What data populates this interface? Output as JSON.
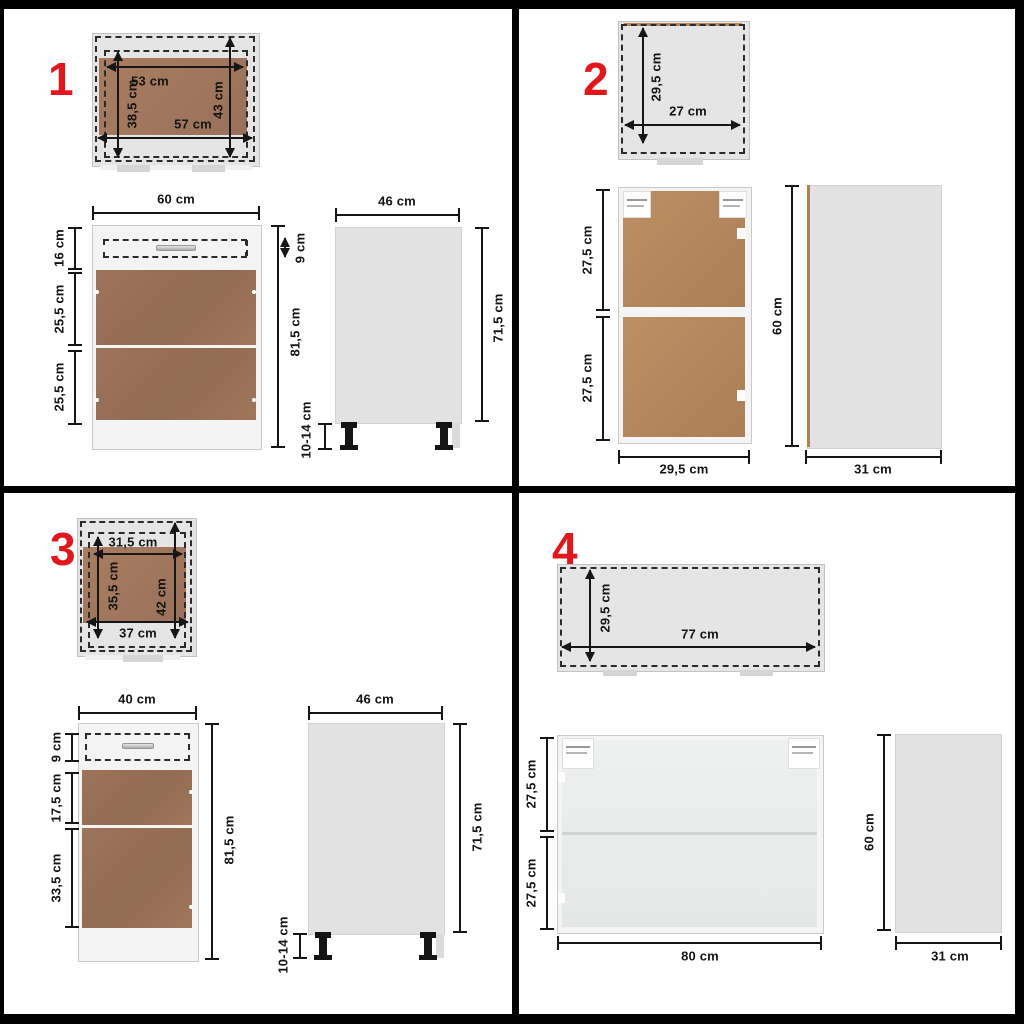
{
  "colors": {
    "accent_red": "#e0181d",
    "frame_black": "#000000",
    "wood_dark": "#9a7159",
    "wood_tan": "#b5875f",
    "panel_gray": "#e3e3e3",
    "glass_gray": "#eaeceb"
  },
  "panels": [
    {
      "number": "1",
      "top": {
        "w_inner": "53 cm",
        "w_outer": "57 cm",
        "d_inner": "38,5 cm",
        "d_outer": "43 cm"
      },
      "front": {
        "width": "60 cm",
        "drawer": "16 cm",
        "drawer_front": "9 cm",
        "door_top": "25,5 cm",
        "door_bottom": "25,5 cm",
        "height": "81,5 cm"
      },
      "side": {
        "depth": "46 cm",
        "height": "71,5 cm",
        "legs": "10-14 cm"
      }
    },
    {
      "number": "2",
      "top": {
        "depth": "29,5 cm",
        "width": "27 cm"
      },
      "front": {
        "sec_top": "27,5 cm",
        "sec_bottom": "27,5 cm",
        "width": "29,5 cm"
      },
      "side": {
        "height": "60 cm",
        "depth": "31 cm"
      }
    },
    {
      "number": "3",
      "top": {
        "w_inner": "31,5 cm",
        "w_outer": "37 cm",
        "d_inner": "35,5 cm",
        "d_outer": "42 cm"
      },
      "front": {
        "width": "40 cm",
        "drawer": "9 cm",
        "door_top": "17,5 cm",
        "door_bottom": "33,5 cm",
        "height": "81,5 cm"
      },
      "side": {
        "depth": "46 cm",
        "height": "71,5 cm",
        "legs": "10-14 cm"
      }
    },
    {
      "number": "4",
      "top": {
        "depth": "29,5 cm",
        "width": "77 cm"
      },
      "front": {
        "sec_top": "27,5 cm",
        "sec_bottom": "27,5 cm",
        "width": "80 cm"
      },
      "side": {
        "height": "60 cm",
        "depth": "31 cm"
      }
    }
  ]
}
